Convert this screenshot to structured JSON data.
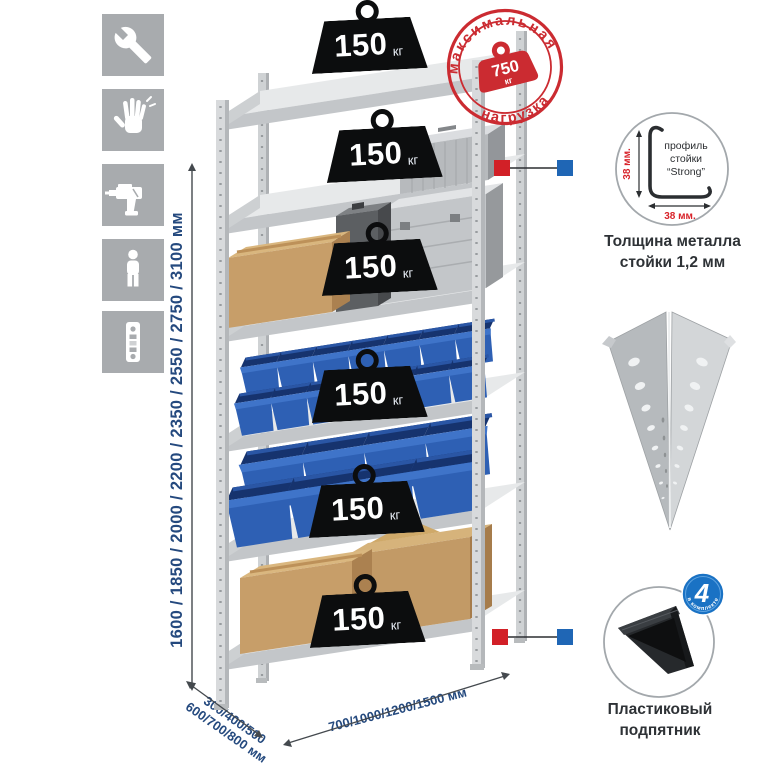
{
  "icons": {
    "tools": "wrench-icon",
    "gloves": "gloves-icon",
    "drill": "drill-icon",
    "person": "person-icon",
    "post": "perforated-post-icon"
  },
  "rack": {
    "shelf_badges": [
      {
        "value": "150",
        "unit": "кг"
      },
      {
        "value": "150",
        "unit": "кг"
      },
      {
        "value": "150",
        "unit": "кг"
      },
      {
        "value": "150",
        "unit": "кг"
      },
      {
        "value": "150",
        "unit": "кг"
      },
      {
        "value": "150",
        "unit": "кг"
      }
    ]
  },
  "max_load_stamp": {
    "arc_top": "максимальная",
    "arc_bottom": "нагрузка",
    "value": "750",
    "unit": "кг"
  },
  "dimensions": {
    "height": "1600 / 1850 / 2000 / 2200 / 2350 / 2550 / 2750 / 3100 мм",
    "depth_line1": "300/400/500",
    "depth_line2": "600/700/800 мм",
    "width": "700/1000/1200/1500 мм"
  },
  "profile_detail": {
    "label_line1": "профиль",
    "label_line2": "стойки",
    "label_line3": "“Strong”",
    "dim_vertical": "38 мм.",
    "dim_horizontal": "38 мм.",
    "caption_line1": "Толщина металла",
    "caption_line2": "стойки 1,2 мм"
  },
  "foot_detail": {
    "badge_value": "4",
    "badge_arc": "в комплекте",
    "caption_line1": "Пластиковый",
    "caption_line2": "подпятник"
  },
  "colors": {
    "stamp_red": "#cb2b31",
    "connector_red": "#d22027",
    "connector_blue": "#1f66b5",
    "bin_blue": "#2e60b4",
    "dim_text_blue": "#24497e",
    "metal_light": "#d8dadc"
  }
}
